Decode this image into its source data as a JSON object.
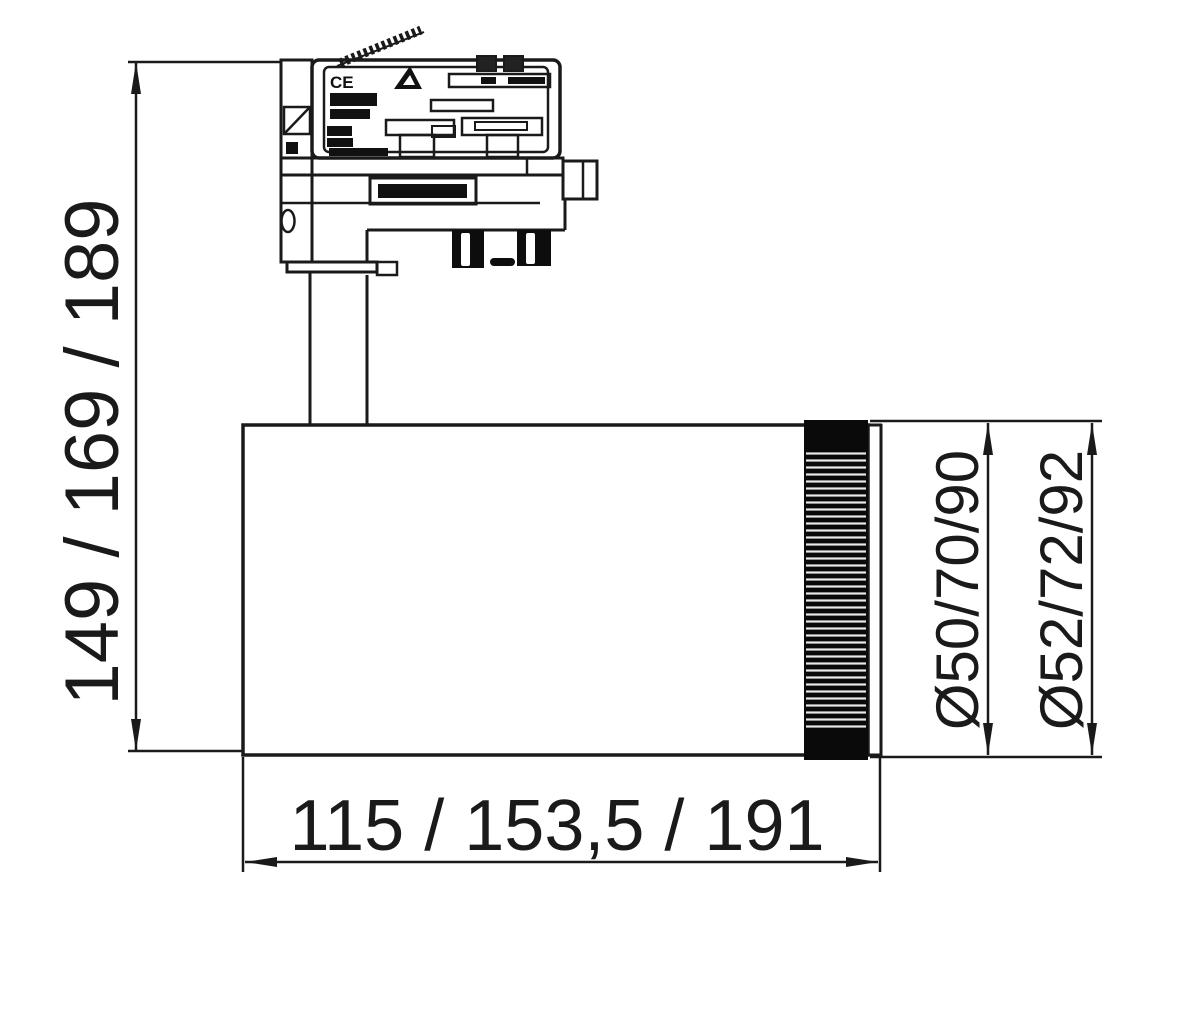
{
  "drawing": {
    "kind": "technical-dimension-drawing",
    "dimensions": {
      "height": "149 / 169 / 189",
      "length": "115 / 153,5 / 191",
      "diameter_inner": "Ø50/70/90",
      "diameter_outer": "Ø52/72/92"
    },
    "markings": {
      "ce": "CE"
    },
    "colors": {
      "background": "#ffffff",
      "line": "#1a1a1a",
      "dark_fill": "#111111"
    }
  }
}
